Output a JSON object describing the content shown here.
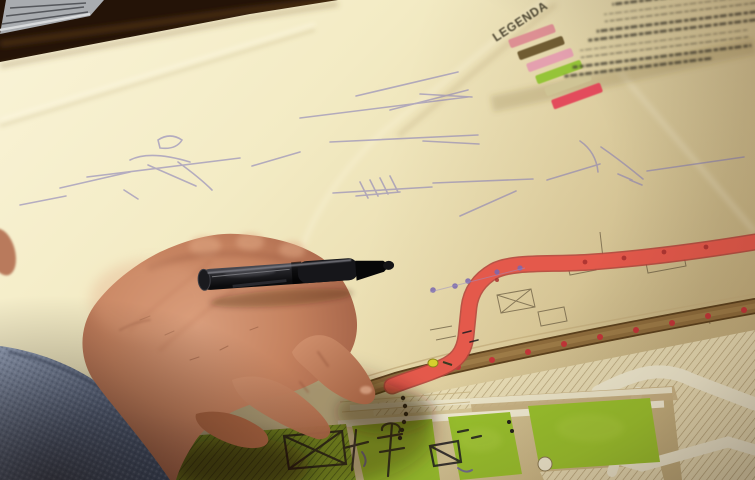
{
  "scene": {
    "alt": "Photograph: a hand holding a capped black marker pen rests on a large folded urban site plan; a red route and a brown road cross the plan, green lawn parcels at bottom, hatched building blocks, blue ballpoint sketch lines, and a colour legend in the top-right corner."
  },
  "legend": {
    "title": "LEGENDA",
    "entry_count": 7,
    "swatches": [
      {
        "name": "swatch-pink-1",
        "color": "#dd8f93"
      },
      {
        "name": "swatch-olive",
        "color": "#6f5c33"
      },
      {
        "name": "swatch-pink-2",
        "color": "#e4a0af"
      },
      {
        "name": "swatch-green",
        "color": "#95c437"
      },
      {
        "name": "swatch-khaki",
        "color": "#cfc495"
      },
      {
        "name": "swatch-red",
        "color": "#e34b5b"
      }
    ]
  },
  "palette": {
    "table_dark": "#241307",
    "paper_light": "#f6efcd",
    "paper_warm": "#e7d9a8",
    "route_red": "#e4594b",
    "road_brown": "#8e6c3c",
    "road_edge": "#5c411d",
    "lawn_green": "#9cc42e",
    "sketch_blue": "#8078b8",
    "marker_black": "#141416",
    "skin_mid": "#c5825f",
    "sleeve_blue": "#76849e",
    "red_dot": "#c23538",
    "yellow_dot": "#d6cf2e",
    "purple_dot": "#7a68b0"
  }
}
